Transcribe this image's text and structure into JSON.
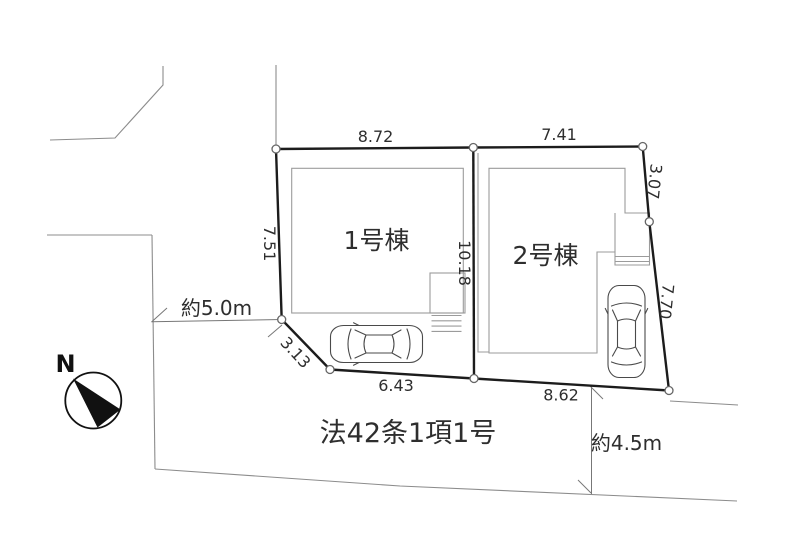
{
  "plan": {
    "north_label": "N",
    "road_note": "法42条1項1号",
    "road_width_west": "約5.0m",
    "road_width_south": "約4.5m",
    "building1": {
      "label": "1号棟"
    },
    "building2": {
      "label": "2号棟"
    },
    "dims": {
      "b1_top": "8.72",
      "b2_top": "7.41",
      "west": "7.51",
      "divider": "10.18",
      "east_upper": "3.07",
      "east_lower": "7.70",
      "southwest_diag": "3.13",
      "b1_bottom": "6.43",
      "b2_bottom": "8.62"
    },
    "colors": {
      "boundary": "#1c1c1c",
      "thin_line": "#8c8c8c",
      "building_line": "#9b9b9b",
      "text": "#2e2e2e"
    }
  }
}
